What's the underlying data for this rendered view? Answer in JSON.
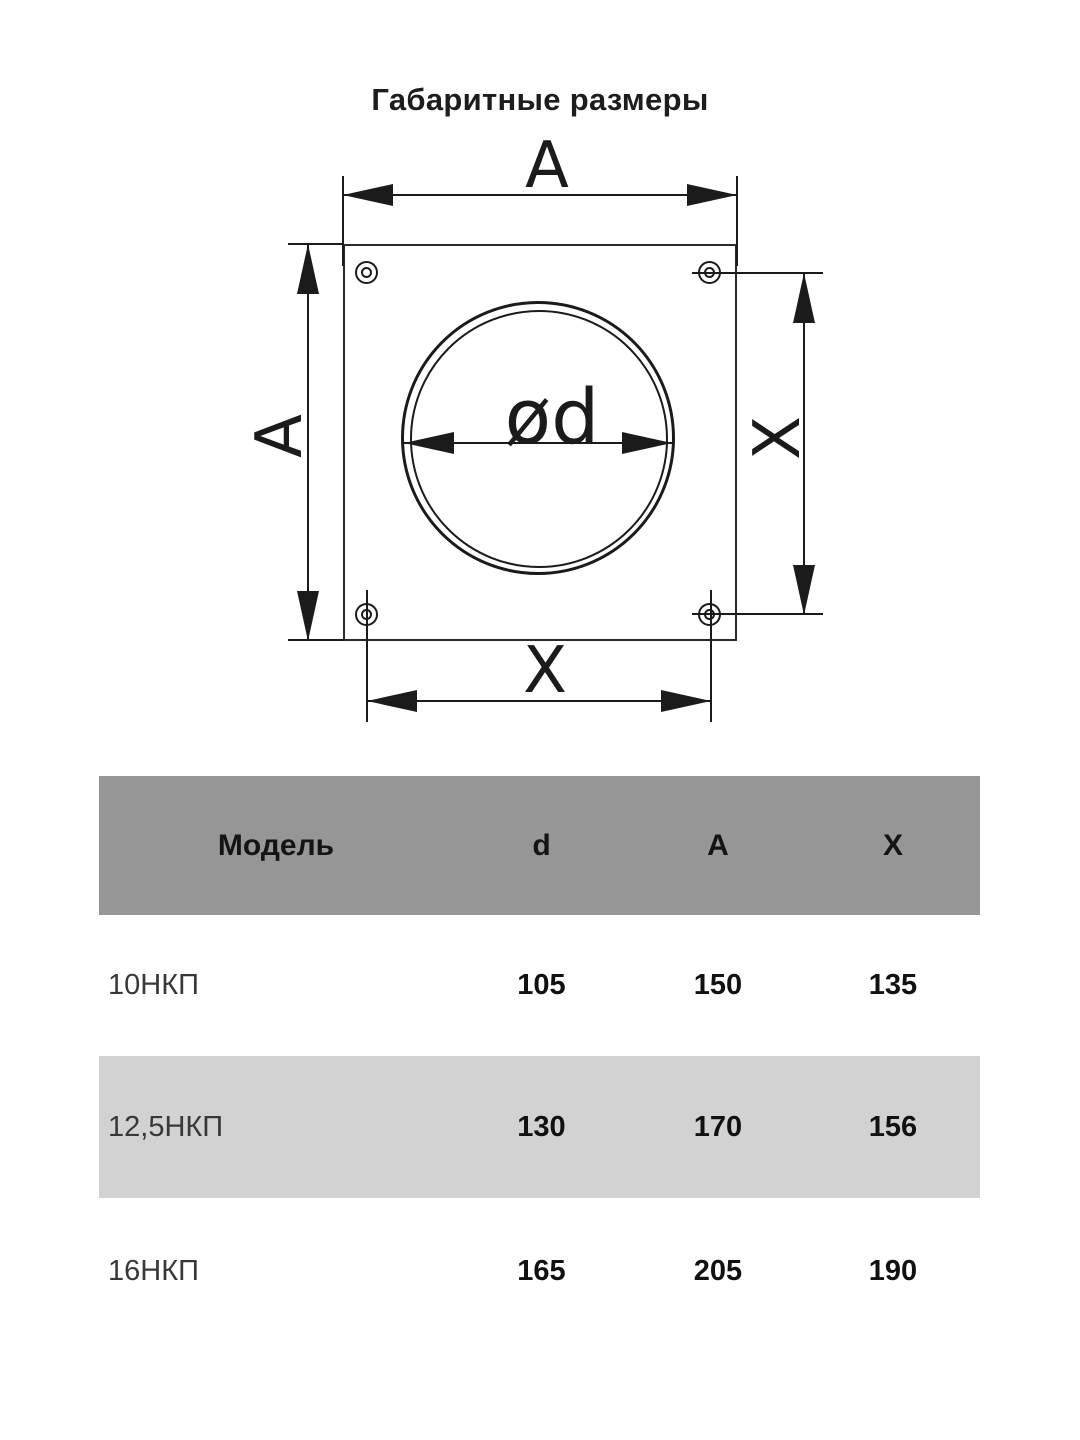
{
  "title": "Габаритные размеры",
  "diagram": {
    "labels": {
      "width_top": "A",
      "height_left": "A",
      "hole_pitch_right": "X",
      "hole_pitch_bottom": "X",
      "diameter": "ød"
    }
  },
  "table": {
    "columns": [
      "Модель",
      "d",
      "A",
      "X"
    ],
    "rows": [
      {
        "model": "10НКП",
        "d": "105",
        "a": "150",
        "x": "135"
      },
      {
        "model": "12,5НКП",
        "d": "130",
        "a": "170",
        "x": "156"
      },
      {
        "model": "16НКП",
        "d": "165",
        "a": "205",
        "x": "190"
      }
    ]
  },
  "colors": {
    "header_bg": "#969696",
    "alt_row_bg": "#d2d2d2",
    "line": "#1b1b1b"
  }
}
